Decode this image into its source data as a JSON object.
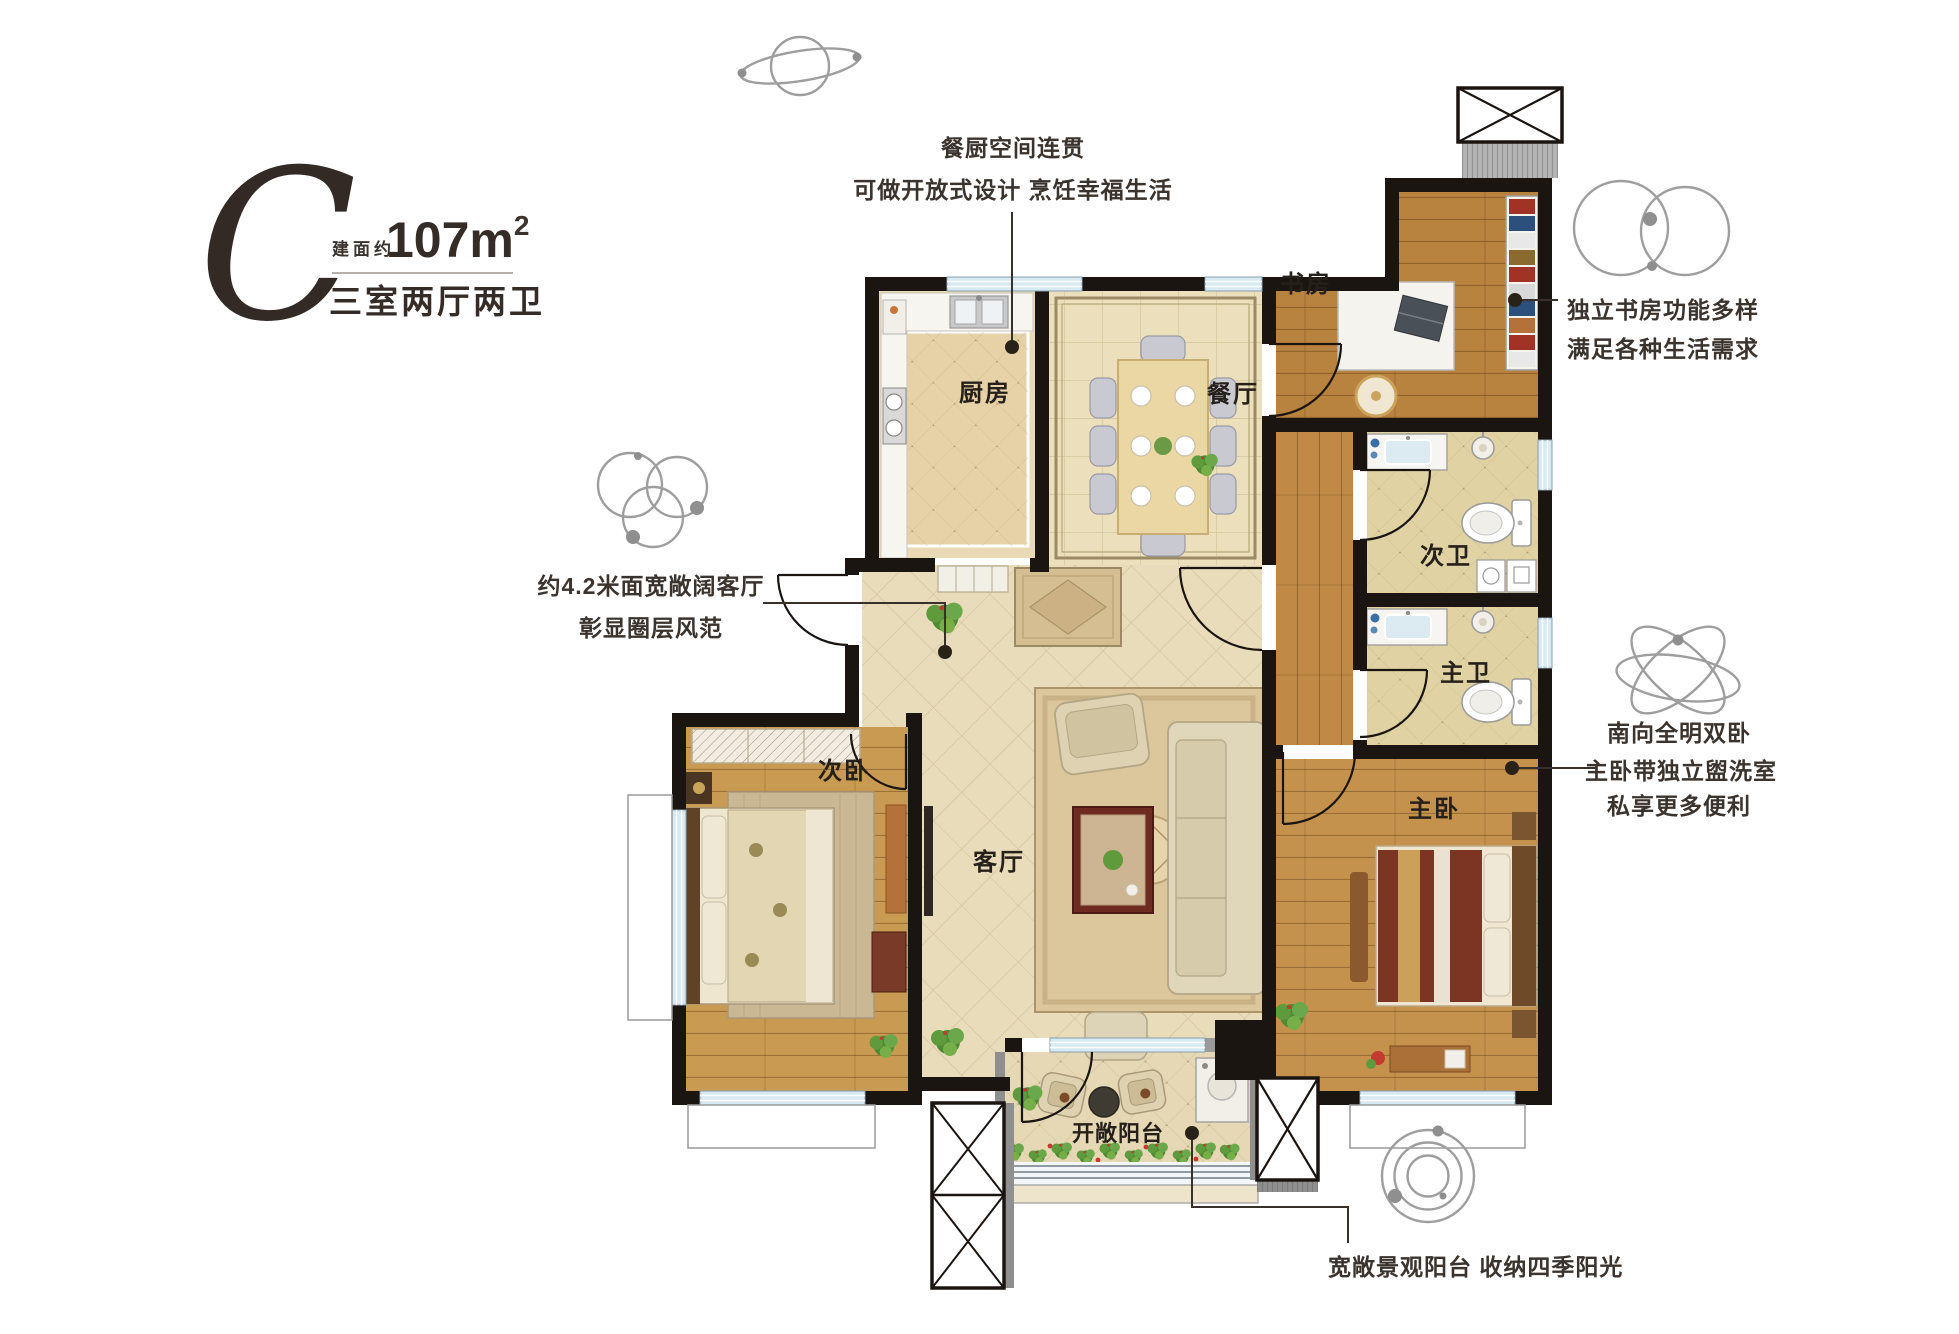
{
  "title": {
    "letter": "C",
    "area_prefix": "建面约",
    "area_value": "107m",
    "area_sup": "2",
    "layout": "三室两厅两卫"
  },
  "annotations": {
    "kitchen_line1": "餐厨空间连贯",
    "kitchen_line2": "可做开放式设计  烹饪幸福生活",
    "study_line1": "独立书房功能多样",
    "study_line2": "满足各种生活需求",
    "living_line1": "约4.2米面宽敞阔客厅",
    "living_line2": "彰显圈层风范",
    "master_line1": "南向全明双卧",
    "master_line2": "主卧带独立盥洗室",
    "master_line3": "私享更多便利",
    "balcony_line1": "宽敞景观阳台  收纳四季阳光"
  },
  "rooms": {
    "kitchen": "厨房",
    "dining": "餐厅",
    "study": "书房",
    "second_bath": "次卫",
    "master_bath": "主卫",
    "second_bedroom": "次卧",
    "living_room": "客厅",
    "master_bedroom": "主卧",
    "balcony": "开敞阳台"
  },
  "colors": {
    "wall_black": "#1b1512",
    "wood_floor": "#c08a46",
    "tile_floor": "#e9dcba",
    "window_glass": "#d7e9f2",
    "icon_gray": "#9e9e9e",
    "text_dark": "#3b332d",
    "plant_green": "#5f9a3d",
    "master_bed_red": "#7c3522"
  }
}
